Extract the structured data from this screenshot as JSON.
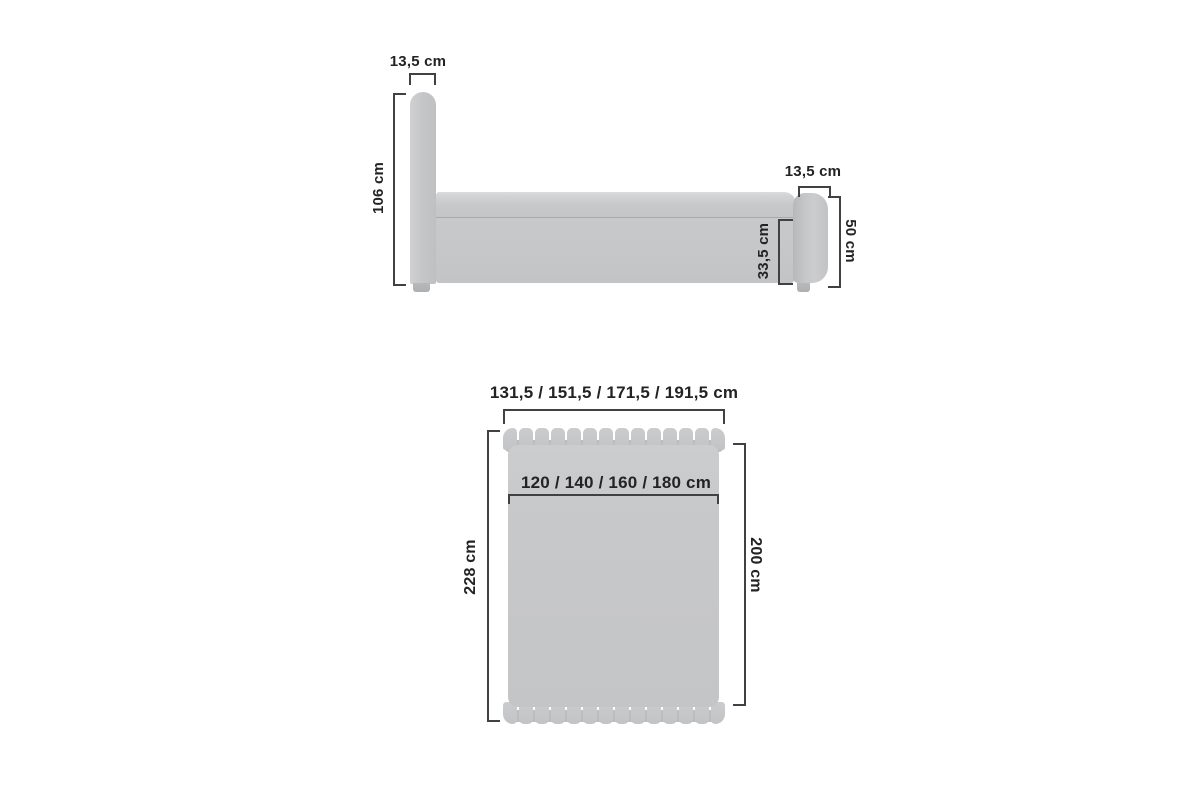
{
  "diagram": {
    "subject": "bed-dimensions",
    "colors": {
      "background": "#ffffff",
      "furniture_gray": "#c6c7c8",
      "furniture_shadow": "#aeafb1",
      "dimension_line": "#414143",
      "text": "#232325"
    },
    "side_view": {
      "headboard_width_label": "13,5 cm",
      "headboard_height_label": "106 cm",
      "footboard_width_label": "13,5 cm",
      "footboard_height_label": "50 cm",
      "base_height_label": "33,5 cm"
    },
    "top_view": {
      "overall_width_label": "131,5 / 151,5 / 171,5 / 191,5 cm",
      "mattress_width_label": "120 / 140 / 160 / 180 cm",
      "overall_length_label": "228 cm",
      "mattress_length_label": "200 cm"
    }
  }
}
